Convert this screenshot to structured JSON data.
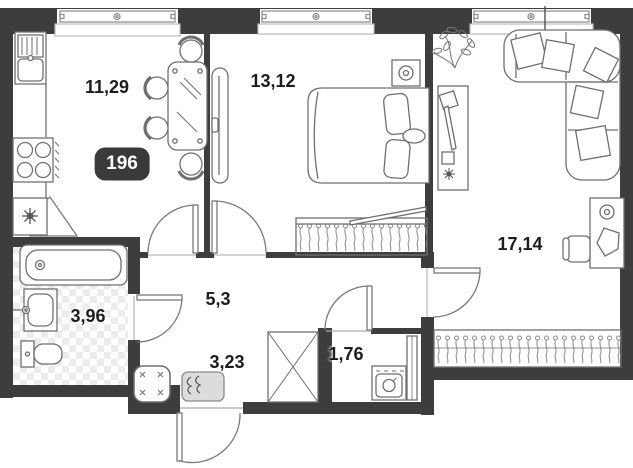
{
  "unit": {
    "number": "196"
  },
  "rooms": {
    "kitchen": {
      "name": "kitchen",
      "area": "11,29"
    },
    "bedroom": {
      "name": "bedroom",
      "area": "13,12"
    },
    "living": {
      "name": "living-room",
      "area": "17,14"
    },
    "hallway": {
      "name": "hallway",
      "area": "5,3"
    },
    "bathroom": {
      "name": "bathroom",
      "area": "3,96"
    },
    "closet": {
      "name": "entry-closet",
      "area": "3,23"
    },
    "laundry": {
      "name": "laundry",
      "area": "1,76"
    }
  },
  "icons": {
    "fridge": "snowflake-icon",
    "stove": "four-burners-icon",
    "bedroom_wardrobe": "hangers-icon",
    "living_wardrobe": "hangers-icon",
    "laundry_washer": "washing-machine-icon",
    "ceiling_lamp": "pendant-light-icon",
    "plant": "plant-icon"
  },
  "colors": {
    "wall": "#3d3d3d",
    "furniture_line": "#6f6f6f",
    "tile": "#ececec",
    "badge_bg": "#3a3a3a",
    "badge_text": "#ffffff",
    "shoe_cabinet_fill": "#dcdcdc",
    "label_text": "#1d1d1d"
  }
}
